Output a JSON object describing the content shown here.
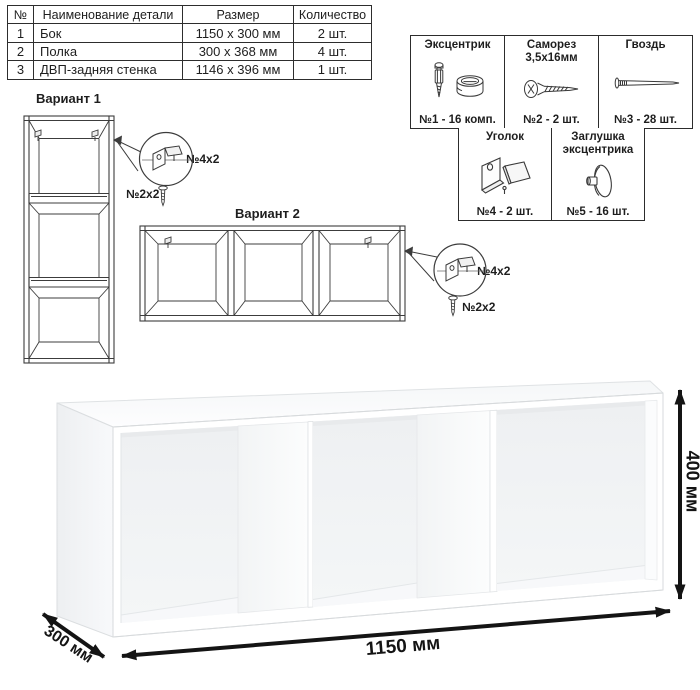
{
  "ink_color": "#2d2d2d",
  "dimension_color": "#141414",
  "parts_table": {
    "headers": [
      "№",
      "Наименование детали",
      "Размер",
      "Количество"
    ],
    "rows": [
      {
        "num": "1",
        "name": "Бок",
        "size": "1150 x 300 мм",
        "qty": "2 шт."
      },
      {
        "num": "2",
        "name": "Полка",
        "size": "300 x 368 мм",
        "qty": "4 шт."
      },
      {
        "num": "3",
        "name": "ДВП-задняя стенка",
        "size": "1146 x 396 мм",
        "qty": "1 шт."
      }
    ]
  },
  "hardware": {
    "row1": [
      {
        "title": "Эксцентрик",
        "icon": "eccentric-cam-bolt-icon",
        "count": "№1 - 16 комп."
      },
      {
        "title": "Саморез 3,5х16мм",
        "icon": "self-tapping-screw-icon",
        "count": "№2 - 2 шт."
      },
      {
        "title": "Гвоздь",
        "icon": "nail-icon",
        "count": "№3 - 28 шт."
      }
    ],
    "row2": [
      {
        "title": "Уголок",
        "icon": "corner-bracket-icon",
        "count": "№4 - 2 шт."
      },
      {
        "title": "Заглушка эксцентрика",
        "icon": "eccentric-cap-icon",
        "count": "№5 - 16 шт."
      }
    ]
  },
  "variant1": {
    "title": "Вариант 1",
    "bracket_label": "№4х2",
    "screw_label": "№2х2"
  },
  "variant2": {
    "title": "Вариант 2",
    "bracket_label": "№4х2",
    "screw_label": "№2х2"
  },
  "dimensions": {
    "width": "1150 мм",
    "depth": "300 мм",
    "height": "400 мм"
  }
}
